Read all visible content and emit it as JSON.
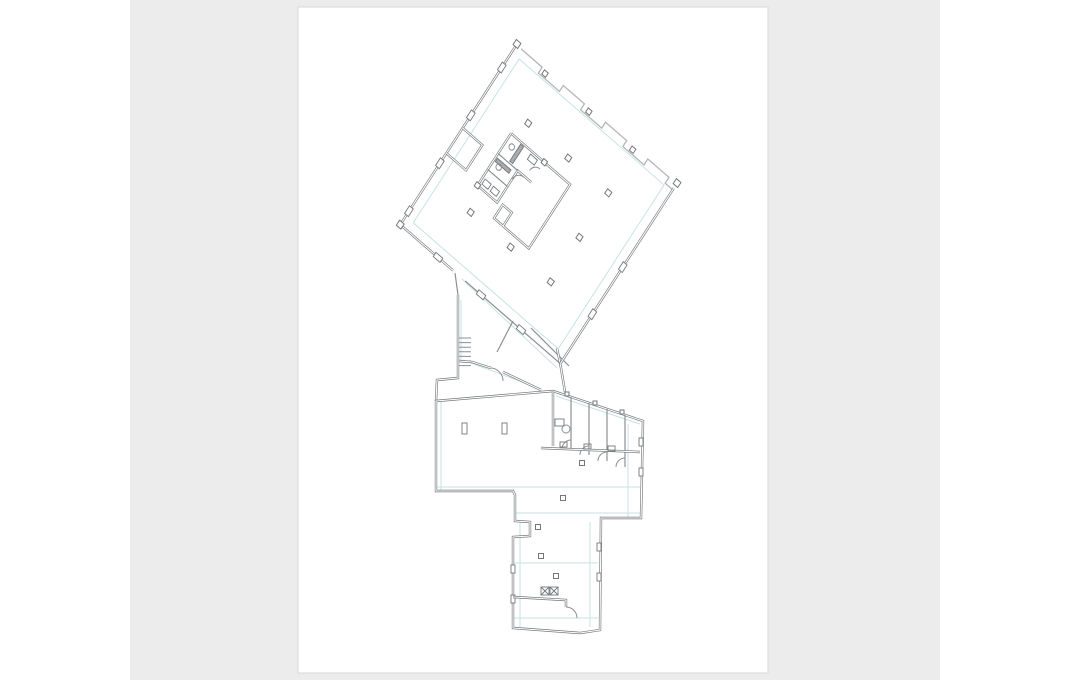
{
  "meta": {
    "description": "Architectural floor plan sheet shown on a white page inside a gray viewer pane"
  },
  "canvas": {
    "w": 1070,
    "h": 680,
    "outer_bg": "#ffffff"
  },
  "pane": {
    "x": 130,
    "y": 0,
    "w": 810,
    "h": 680,
    "fill": "#ececec"
  },
  "page": {
    "x": 298,
    "y": 7,
    "w": 470,
    "h": 666,
    "fill": "#ffffff",
    "edge": "#d9d9d9"
  },
  "colors": {
    "wall": "#73777a",
    "thin": "#8b8f92",
    "saw": "#b2b5b7",
    "grid": "#c6e3e2",
    "hatch": "#a9acae",
    "white": "#ffffff"
  },
  "upper_matrix": [
    0.755,
    0.656,
    -0.543,
    0.84,
    517,
    44
  ],
  "shapes": [
    {
      "t": "line",
      "f": "u",
      "c": "grid",
      "w": 1,
      "d": "M10,10 L202,10 L202,205 L10,205 Z"
    },
    {
      "t": "line",
      "c": "grid",
      "w": 1,
      "d": "M462,279 L557,368"
    },
    {
      "t": "line",
      "c": "grid",
      "w": 1,
      "d": "M461,300 L461,360"
    },
    {
      "t": "line",
      "c": "grid",
      "w": 1,
      "d": "M463,360 L541,389"
    },
    {
      "t": "line",
      "c": "grid",
      "w": 1,
      "d": "M437,487 L640,487"
    },
    {
      "t": "line",
      "c": "grid",
      "w": 1,
      "d": "M441,402 L441,490"
    },
    {
      "t": "line",
      "c": "grid",
      "w": 1,
      "d": "M628,424 L628,517"
    },
    {
      "t": "line",
      "c": "grid",
      "w": 1,
      "d": "M516,513 L640,513"
    },
    {
      "t": "line",
      "c": "grid",
      "w": 1,
      "d": "M520,522 L520,627"
    },
    {
      "t": "line",
      "c": "grid",
      "w": 1,
      "d": "M590,522 L590,627"
    },
    {
      "t": "line",
      "c": "grid",
      "w": 1,
      "d": "M514,563 L598,563"
    },
    {
      "t": "line",
      "c": "grid",
      "w": 1,
      "d": "M514,618 L598,618"
    },
    {
      "t": "line",
      "c": "grid",
      "w": 1,
      "d": "M556,396 L640,424"
    },
    {
      "t": "line",
      "f": "u",
      "c": "saw",
      "w": 1.3,
      "d": "M6,1 L34,1 L34,8 L62,8 L62,1 L90,1 L90,8 L118,8 L118,1 L146,1 L146,8 L174,8 L174,1 L202,1 L202,8 L212,8"
    },
    {
      "t": "wall",
      "f": "u",
      "d": "M0,-2 L0,215"
    },
    {
      "t": "wall",
      "f": "u",
      "d": "M0,215 L70,215"
    },
    {
      "t": "line",
      "f": "u",
      "c": "thin",
      "w": 1.2,
      "d": "M86,215 L212,215"
    },
    {
      "t": "wall",
      "f": "u",
      "d": "M212,6 L212,215"
    },
    {
      "t": "wall",
      "f": "u",
      "d": "M0,100 L26,100 L26,130 L0,130"
    },
    {
      "t": "wall",
      "f": "u",
      "d": "M88,72 L122,72 L122,148 L88,148 L88,132 L76,132 L76,148 L88,148"
    },
    {
      "t": "wall",
      "f": "u",
      "d": "M44,72 L88,72"
    },
    {
      "t": "wall",
      "f": "u",
      "d": "M44,72 L44,134 L70,134 L70,96 L88,96"
    },
    {
      "t": "line",
      "f": "u",
      "c": "thin",
      "w": 1.2,
      "d": "M44,96 L70,96 M44,115 L70,115"
    },
    {
      "t": "rect",
      "f": "u",
      "x": 58,
      "y": 74,
      "w": 4,
      "h": 20,
      "fl": "hatch"
    },
    {
      "t": "rect",
      "f": "u",
      "x": 46,
      "y": 100,
      "w": 18,
      "h": 4,
      "fl": "hatch"
    },
    {
      "t": "circ",
      "f": "u",
      "x": 52,
      "y": 82,
      "r": 3
    },
    {
      "t": "circ",
      "f": "u",
      "x": 52,
      "y": 106,
      "r": 3
    },
    {
      "t": "rect",
      "f": "u",
      "x": 72,
      "y": 75,
      "w": 9,
      "h": 6
    },
    {
      "t": "rect",
      "f": "u",
      "x": 47,
      "y": 124,
      "w": 8,
      "h": 6
    },
    {
      "t": "rect",
      "f": "u",
      "x": 58,
      "y": 124,
      "w": 8,
      "h": 6
    },
    {
      "t": "arc",
      "f": "u",
      "d": "M70,106 A9,9 0 0 1 79,97"
    },
    {
      "t": "arc",
      "f": "u",
      "d": "M88,80 A8,8 0 0 0 80,88"
    },
    {
      "t": "sq",
      "f": "u",
      "x": 53,
      "y": 53,
      "s": 5.5
    },
    {
      "t": "sq",
      "f": "u",
      "x": 106,
      "y": 53,
      "s": 5.5
    },
    {
      "t": "sq",
      "f": "u",
      "x": 159,
      "y": 53,
      "s": 5.5
    },
    {
      "t": "sq",
      "f": "u",
      "x": 159,
      "y": 106,
      "s": 5.5
    },
    {
      "t": "sq",
      "f": "u",
      "x": 159,
      "y": 159,
      "s": 5.5
    },
    {
      "t": "sq",
      "f": "u",
      "x": 106,
      "y": 159,
      "s": 5.5
    },
    {
      "t": "sq",
      "f": "u",
      "x": 53,
      "y": 159,
      "s": 5.5
    },
    {
      "t": "sq",
      "f": "u",
      "x": 40,
      "y": 4,
      "s": 5
    },
    {
      "t": "sq",
      "f": "u",
      "x": 98,
      "y": 4,
      "s": 5
    },
    {
      "t": "sq",
      "f": "u",
      "x": 156,
      "y": 4,
      "s": 5
    },
    {
      "t": "sq",
      "f": "u",
      "x": 0,
      "y": 0,
      "s": 6
    },
    {
      "t": "sq",
      "f": "u",
      "x": 212,
      "y": 0,
      "s": 6
    },
    {
      "t": "sq",
      "f": "u",
      "x": 0,
      "y": 215,
      "s": 6
    },
    {
      "t": "rect",
      "f": "u",
      "x": -2.5,
      "y": 23.5,
      "w": 5,
      "h": 9,
      "fl": "white"
    },
    {
      "t": "rect",
      "f": "u",
      "x": -2.5,
      "y": 80.5,
      "w": 5,
      "h": 9,
      "fl": "white"
    },
    {
      "t": "rect",
      "f": "u",
      "x": -2.5,
      "y": 137.5,
      "w": 5,
      "h": 9,
      "fl": "white"
    },
    {
      "t": "rect",
      "f": "u",
      "x": -2.5,
      "y": 194.5,
      "w": 5,
      "h": 9,
      "fl": "white"
    },
    {
      "t": "rect",
      "f": "u",
      "x": 45.5,
      "y": 212.5,
      "w": 9,
      "h": 5,
      "fl": "white"
    },
    {
      "t": "rect",
      "f": "u",
      "x": 102.5,
      "y": 212.5,
      "w": 9,
      "h": 5,
      "fl": "white"
    },
    {
      "t": "rect",
      "f": "u",
      "x": 155.5,
      "y": 212.5,
      "w": 9,
      "h": 5,
      "fl": "white"
    },
    {
      "t": "rect",
      "f": "u",
      "x": 209.5,
      "y": 95.5,
      "w": 5,
      "h": 9,
      "fl": "white"
    },
    {
      "t": "rect",
      "f": "u",
      "x": 209.5,
      "y": 151.5,
      "w": 5,
      "h": 9,
      "fl": "white"
    },
    {
      "t": "sq",
      "f": "u",
      "x": 88,
      "y": 72,
      "s": 5
    },
    {
      "t": "sq",
      "f": "u",
      "x": 44,
      "y": 134,
      "s": 5
    },
    {
      "t": "line",
      "c": "thin",
      "w": 1.2,
      "d": "M455,273 L458,295"
    },
    {
      "t": "line",
      "c": "thin",
      "w": 1.2,
      "d": "M513,321 L497,352"
    },
    {
      "t": "line",
      "c": "thin",
      "w": 1.2,
      "d": "M531,328 L569,366"
    },
    {
      "t": "wall",
      "d": "M458,295 L458,378 L437,380 L436,401"
    },
    {
      "t": "ladder",
      "x": 459,
      "y": 338,
      "w": 12,
      "n": 6,
      "dy": 4.6
    },
    {
      "t": "wall",
      "d": "M459,361 L472,362 L491,368"
    },
    {
      "t": "wall",
      "d": "M503,372 L541,390"
    },
    {
      "t": "arc",
      "d": "M491,368 A13,13 0 0 1 503,381"
    },
    {
      "t": "wall",
      "d": "M557,348 L561,368 L565,392"
    },
    {
      "t": "wall",
      "d": "M436,401 L553,391 L643,421 L641,518 L601,518 L600,630 L580,633 L513,628 L513,537 L530,536 L530,522 L515,521 L515,495 L513,491 L436,491 Z"
    },
    {
      "t": "wall",
      "d": "M553,391 L553,446"
    },
    {
      "t": "line",
      "c": "thin",
      "w": 1.2,
      "d": "M571,397 L571,449"
    },
    {
      "t": "line",
      "c": "thin",
      "w": 1.2,
      "d": "M589,403 L589,455"
    },
    {
      "t": "line",
      "c": "thin",
      "w": 1.2,
      "d": "M607,409 L607,461"
    },
    {
      "t": "line",
      "c": "thin",
      "w": 1.2,
      "d": "M625,415 L625,467"
    },
    {
      "t": "arc",
      "d": "M562,449 A9,9 0 0 1 571,440"
    },
    {
      "t": "arc",
      "d": "M580,455 A9,9 0 0 1 589,446"
    },
    {
      "t": "arc",
      "d": "M598,461 A9,9 0 0 1 607,452"
    },
    {
      "t": "arc",
      "d": "M616,467 A9,9 0 0 1 625,458"
    },
    {
      "t": "wall",
      "d": "M541,448 L640,452"
    },
    {
      "t": "rect",
      "x": 560,
      "y": 442,
      "w": 7,
      "h": 5
    },
    {
      "t": "rect",
      "x": 584,
      "y": 444,
      "w": 7,
      "h": 5
    },
    {
      "t": "rect",
      "x": 608,
      "y": 446,
      "w": 7,
      "h": 5
    },
    {
      "t": "circ",
      "x": 566,
      "y": 429,
      "r": 4
    },
    {
      "t": "rect",
      "x": 555,
      "y": 419,
      "w": 9,
      "h": 7
    },
    {
      "t": "rect",
      "x": 462,
      "y": 423,
      "w": 5,
      "h": 11,
      "fl": "white"
    },
    {
      "t": "rect",
      "x": 502,
      "y": 423,
      "w": 5,
      "h": 11,
      "fl": "white"
    },
    {
      "t": "sq",
      "x": 582,
      "y": 463,
      "s": 5
    },
    {
      "t": "sq",
      "x": 563,
      "y": 498,
      "s": 5
    },
    {
      "t": "sq",
      "x": 538,
      "y": 527,
      "s": 5
    },
    {
      "t": "sq",
      "x": 541,
      "y": 556,
      "s": 5
    },
    {
      "t": "sq",
      "x": 556,
      "y": 576,
      "s": 5
    },
    {
      "t": "rect",
      "x": 639,
      "y": 438,
      "w": 4,
      "h": 8,
      "fl": "white"
    },
    {
      "t": "rect",
      "x": 639,
      "y": 468,
      "w": 4,
      "h": 8,
      "fl": "white"
    },
    {
      "t": "rect",
      "x": 511,
      "y": 565,
      "w": 4,
      "h": 8,
      "fl": "white"
    },
    {
      "t": "rect",
      "x": 511,
      "y": 595,
      "w": 4,
      "h": 8,
      "fl": "white"
    },
    {
      "t": "rect",
      "x": 597,
      "y": 543,
      "w": 4,
      "h": 8,
      "fl": "white"
    },
    {
      "t": "rect",
      "x": 597,
      "y": 573,
      "w": 4,
      "h": 8,
      "fl": "white"
    },
    {
      "t": "wall",
      "d": "M513,597 L566,600 L566,607"
    },
    {
      "t": "arc",
      "d": "M566,607 A11,11 0 0 1 577,618"
    },
    {
      "t": "xbox",
      "x": 541,
      "y": 587,
      "s": 8
    },
    {
      "t": "xbox",
      "x": 550,
      "y": 587,
      "s": 8
    },
    {
      "t": "sq",
      "x": 567,
      "y": 394,
      "s": 4
    },
    {
      "t": "sq",
      "x": 595,
      "y": 403,
      "s": 4
    },
    {
      "t": "sq",
      "x": 622,
      "y": 412,
      "s": 4
    }
  ]
}
